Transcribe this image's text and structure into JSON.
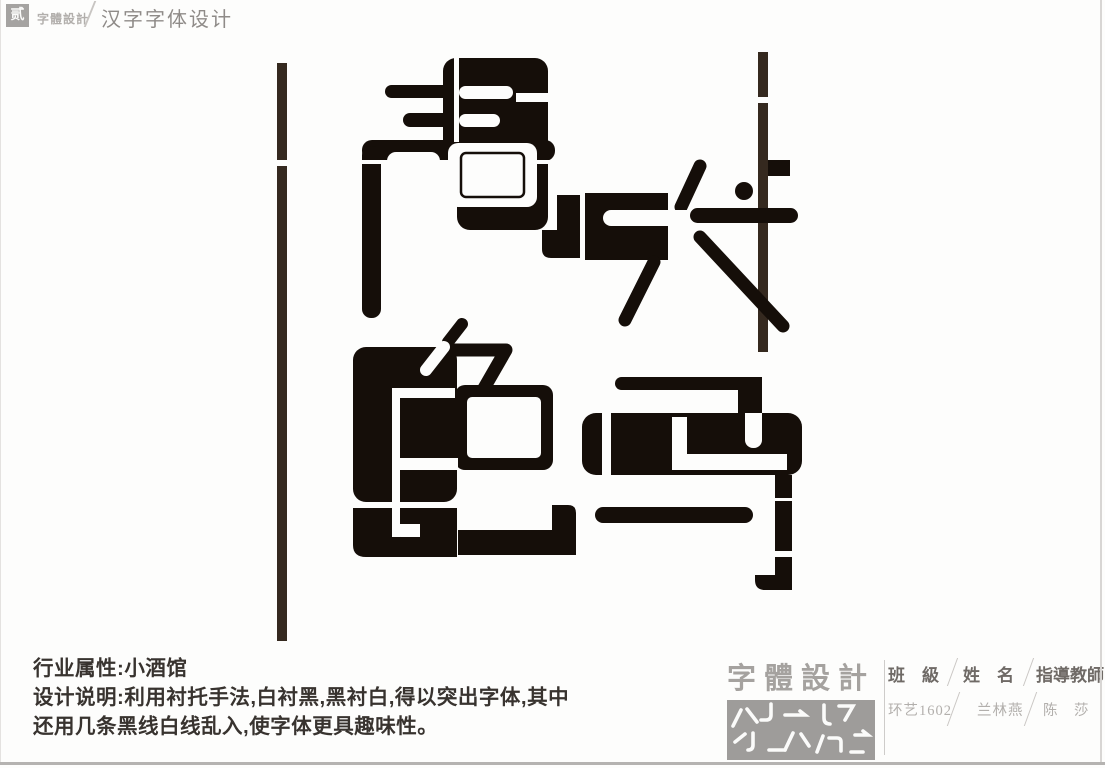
{
  "page": {
    "background": "#fdfdfc",
    "ink_black": "#150e09",
    "guide_line_brown": "#35291f",
    "gray_accent": "#a5a29f"
  },
  "header": {
    "logo_char": "贰",
    "brand": "字體設計",
    "separator": "/",
    "subtitle": "汉字字体设计"
  },
  "artwork": {
    "characters": "声色犬马",
    "style_note": "black geometric letterforms with white counterforms and two vertical guide lines"
  },
  "description": {
    "line1": "行业属性:小酒馆",
    "line2": "设计说明:利用衬托手法,白衬黑,黑衬白,得以突出字体,其中",
    "line3": "还用几条黑线白线乱入,使字体更具趣味性。"
  },
  "credits": {
    "brand": "字體設計",
    "separator": "/",
    "columns": [
      {
        "label": "班　級",
        "value": "环艺1602"
      },
      {
        "label": "姓　名",
        "value": "兰林燕"
      },
      {
        "label": "指導教師",
        "value": "陈　莎"
      }
    ]
  }
}
